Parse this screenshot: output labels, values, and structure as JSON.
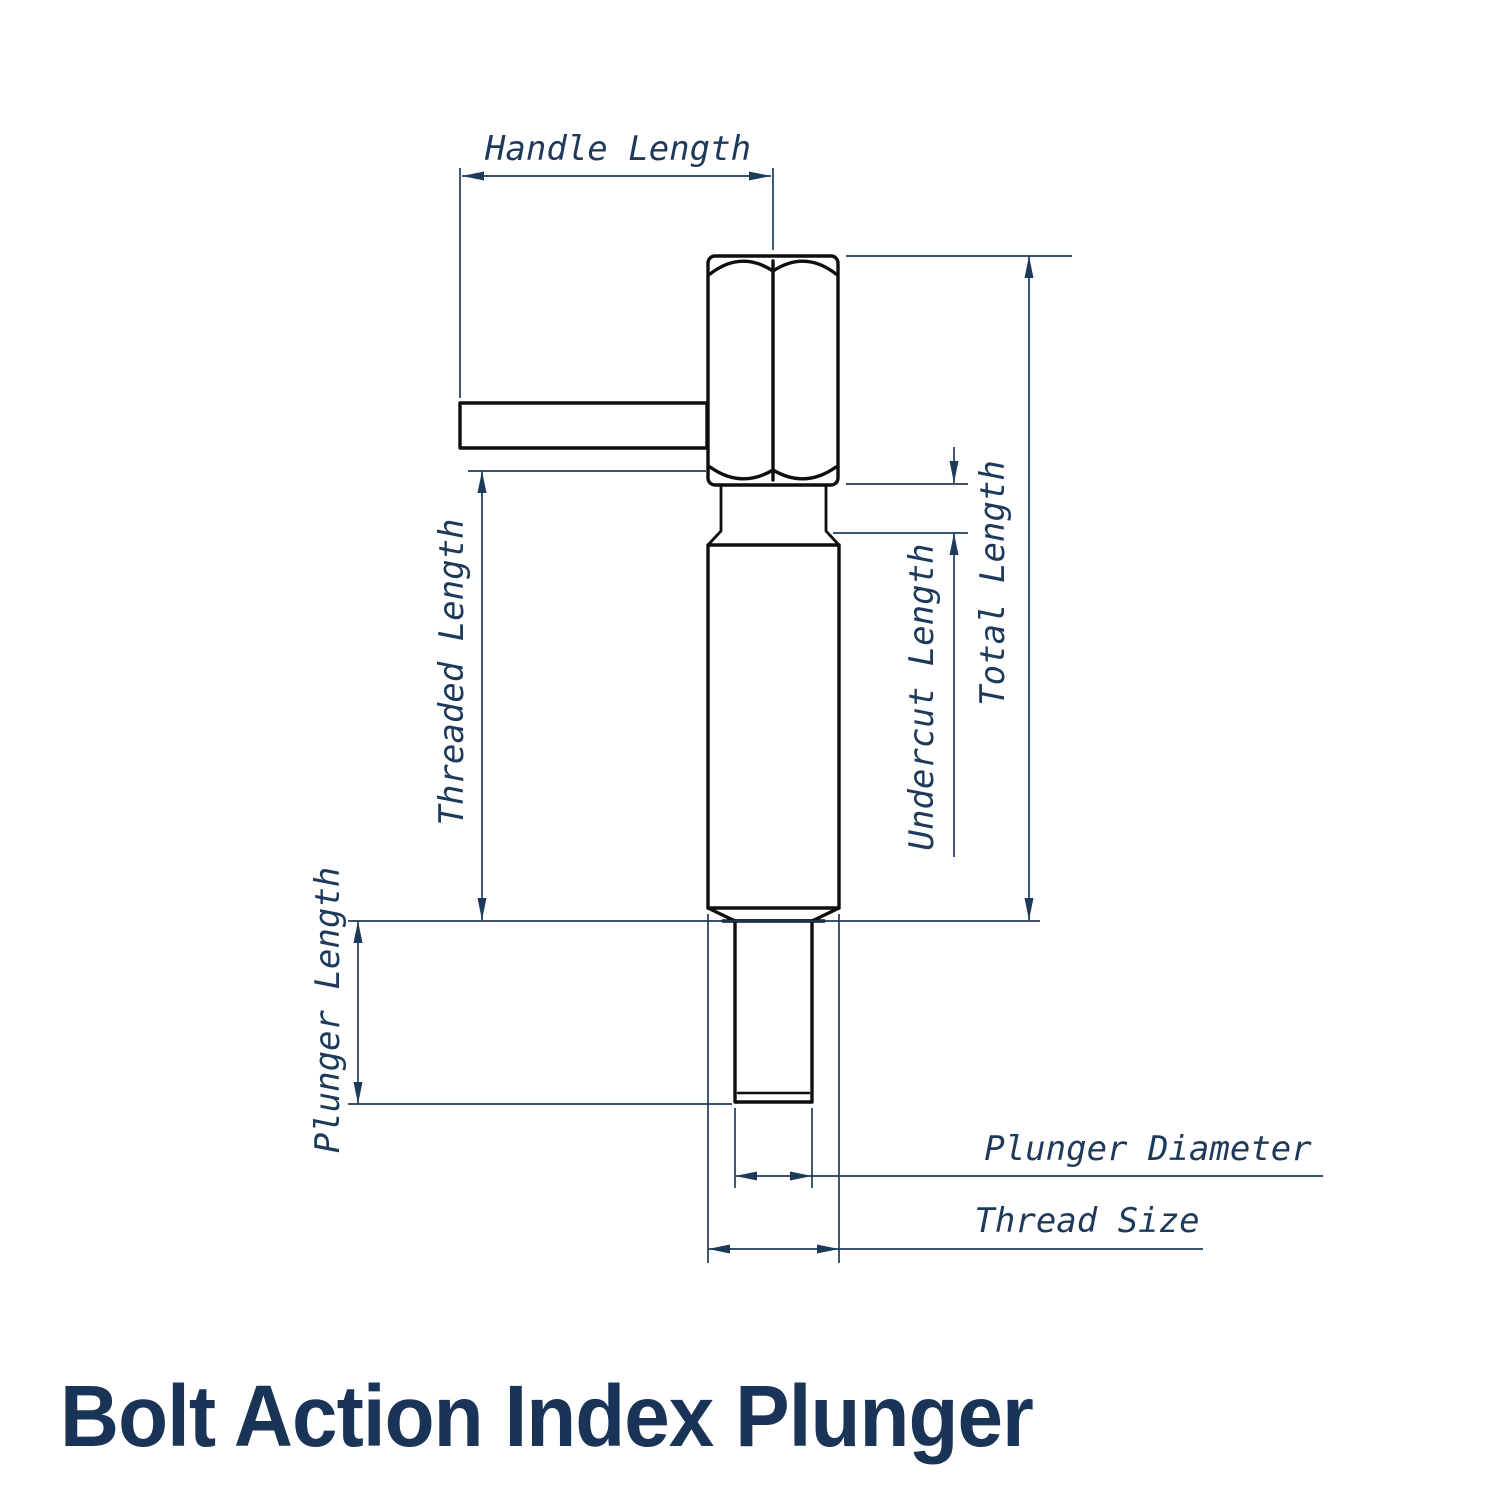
{
  "title": {
    "text": "Bolt Action Index Plunger"
  },
  "labels": {
    "handle_length": "Handle Length",
    "threaded_length": "Threaded Length",
    "plunger_length": "Plunger Length",
    "undercut_length": "Undercut Length",
    "total_length": "Total Length",
    "plunger_diameter": "Plunger Diameter",
    "thread_size": "Thread Size"
  },
  "colors": {
    "background": "#ffffff",
    "outline": "#0f0f0f",
    "dimension": "#1e3a5a",
    "label_text": "#1e3a5a",
    "title": "#1a3457"
  }
}
